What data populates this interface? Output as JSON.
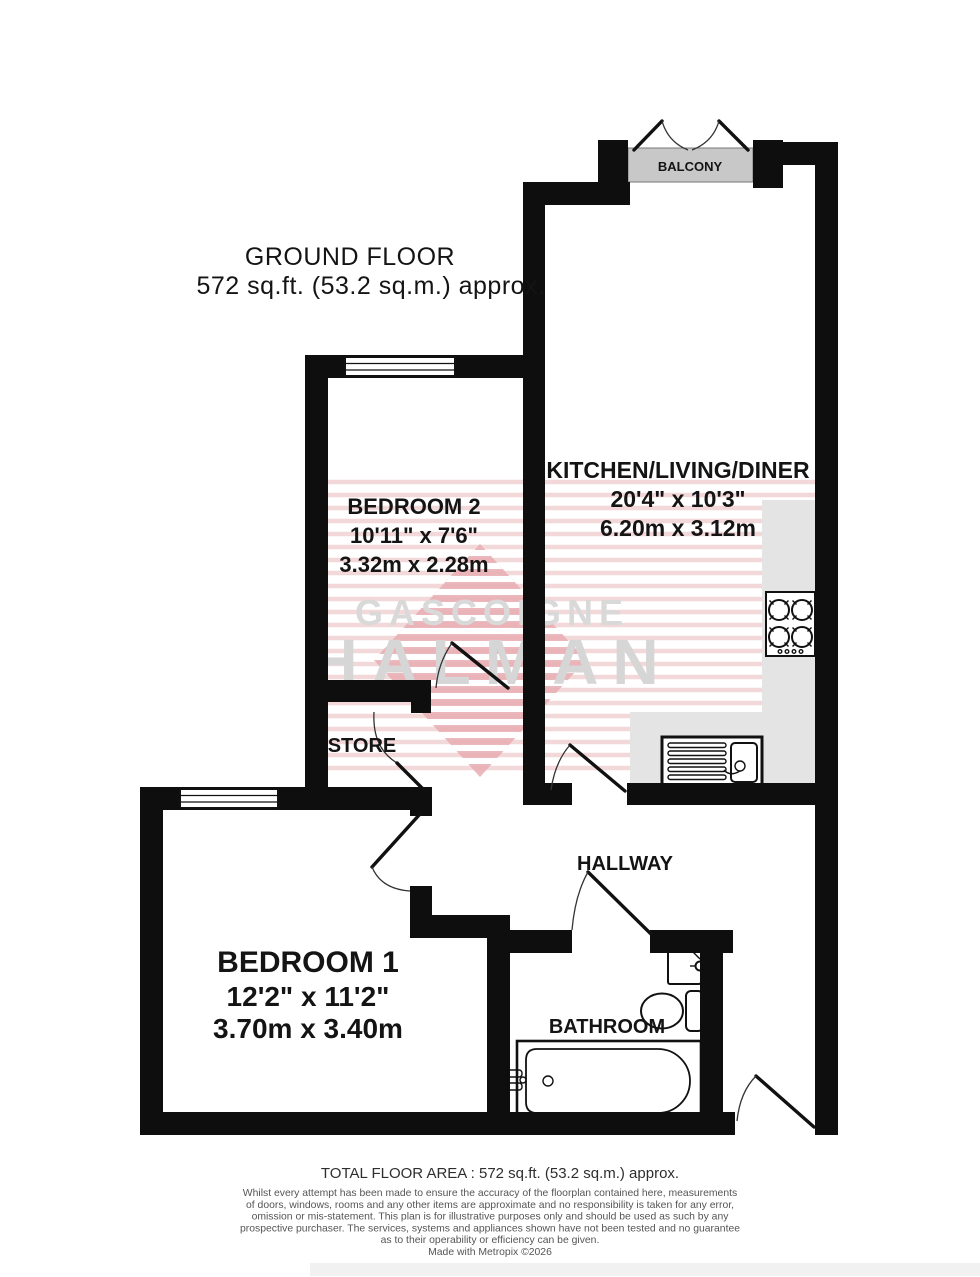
{
  "header": {
    "floor_label": "GROUND FLOOR",
    "floor_area": "572 sq.ft. (53.2 sq.m.) approx."
  },
  "rooms": {
    "balcony": {
      "name": "BALCONY"
    },
    "kitchen": {
      "name": "KITCHEN/LIVING/DINER",
      "dims_imperial": "20'4\" x 10'3\"",
      "dims_metric": "6.20m x 3.12m"
    },
    "bedroom2": {
      "name": "BEDROOM 2",
      "dims_imperial": "10'11\" x 7'6\"",
      "dims_metric": "3.32m x 2.28m"
    },
    "store": {
      "name": "STORE"
    },
    "hallway": {
      "name": "HALLWAY"
    },
    "bedroom1": {
      "name": "BEDROOM 1",
      "dims_imperial": "12'2\" x 11'2\"",
      "dims_metric": "3.70m x 3.40m"
    },
    "bathroom": {
      "name": "BATHROOM"
    }
  },
  "watermark": {
    "line1": "GASCOIGNE",
    "line2": "HALMAN"
  },
  "footer": {
    "total_area": "TOTAL FLOOR AREA : 572 sq.ft. (53.2 sq.m.) approx.",
    "disclaimer_lines": [
      "Whilst every attempt has been made to ensure the accuracy of the floorplan contained here, measurements",
      "of doors, windows, rooms and any other items are approximate and no responsibility is taken for any error,",
      "omission or mis-statement. This plan is for illustrative purposes only and should be used as such by any",
      "prospective purchaser. The services, systems and appliances shown have not been tested and no guarantee",
      "as to their operability or efficiency can be given.",
      "Made with Metropix ©2026"
    ]
  },
  "colors": {
    "wall": "#0e0e0e",
    "balcony_fill": "#c8c8c8",
    "counter_fill": "#e4e4e4",
    "watermark_text": "#d8d8d8",
    "watermark_pink": "#e8adb1",
    "watermark_stripe": "#f1d2d4"
  }
}
